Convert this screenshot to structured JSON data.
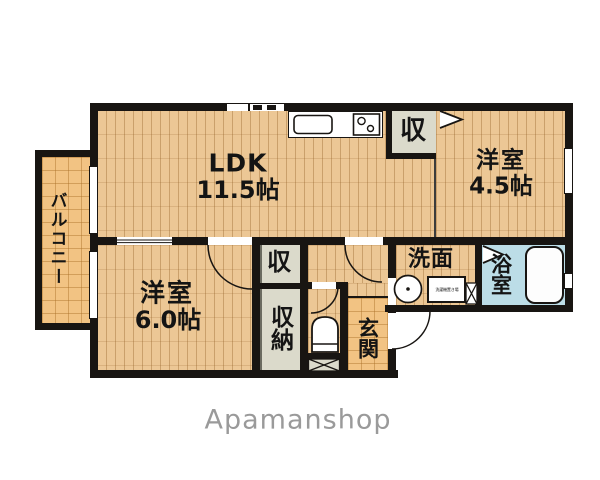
{
  "brand": {
    "logo_text": "Apamanshop"
  },
  "colors": {
    "wall": "#181512",
    "wood_floor": "#ecc795",
    "tile_floor": "#f2c383",
    "closet_fill": "#dbdacb",
    "bathroom_fill": "#bcdde7",
    "logo_gray": "#9a9a9a"
  },
  "rooms": {
    "ldk": {
      "label": "LDK",
      "size": "11.5帖"
    },
    "western_4_5": {
      "label": "洋室",
      "size": "4.5帖"
    },
    "western_6_0": {
      "label": "洋室",
      "size": "6.0帖"
    },
    "balcony": {
      "label": "バルコニー"
    },
    "entrance": {
      "label": "玄関"
    },
    "washroom": {
      "label": "洗面"
    },
    "bathroom": {
      "label": "浴室"
    },
    "storage_upper": {
      "label": "収"
    },
    "storage_hall": {
      "label": "収"
    },
    "storage_closet": {
      "label": "収納"
    },
    "washer_space": {
      "label": "洗濯機置き場"
    }
  }
}
